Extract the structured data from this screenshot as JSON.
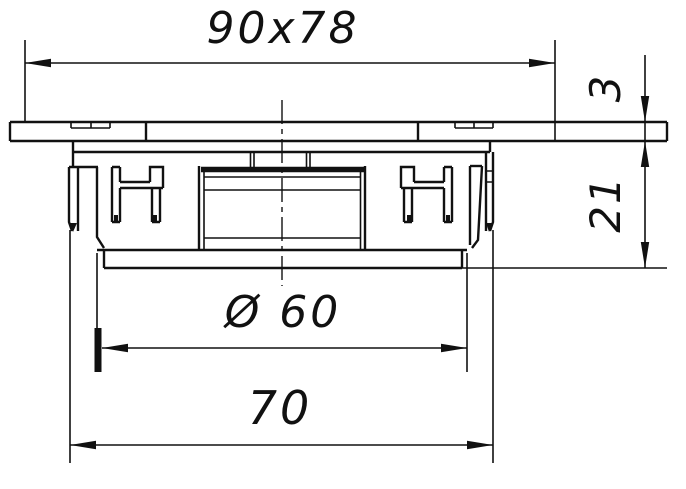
{
  "drawing": {
    "type": "technical-drawing",
    "view": "front-section-view",
    "dimensions": {
      "flange_size": "90x78",
      "flange_thickness": "3",
      "body_depth": "21",
      "diameter": "Ø 60",
      "mounting_span": "70"
    },
    "colors": {
      "ink": "#111111",
      "background": "#ffffff"
    }
  }
}
